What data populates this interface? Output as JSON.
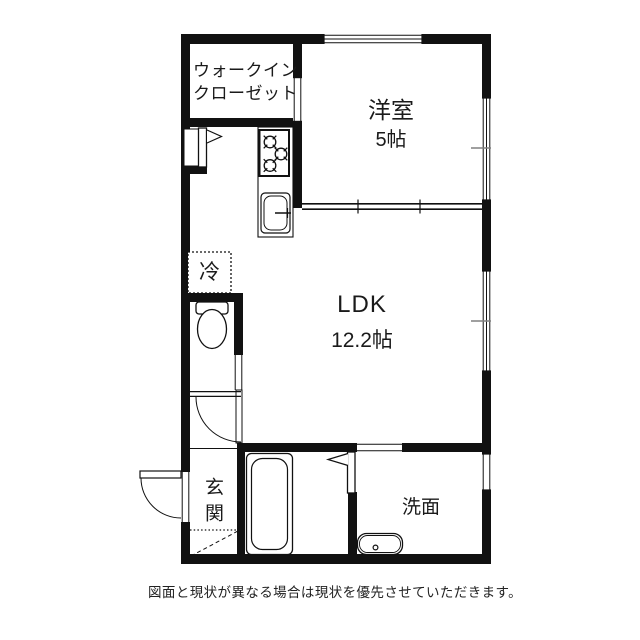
{
  "floorplan": {
    "rooms": {
      "walk_in_closet": {
        "label": "ウォークイン\nクローゼット"
      },
      "western_room": {
        "label": "洋室",
        "size": "5帖"
      },
      "ldk": {
        "label": "LDK",
        "size": "12.2帖"
      },
      "fridge_space": {
        "label": "冷"
      },
      "entrance": {
        "label": "玄関"
      },
      "washroom": {
        "label": "洗面"
      }
    },
    "disclaimer": "図面と現状が異なる場合は現状を優先させていただきます。",
    "colors": {
      "wall": "#111111",
      "text": "#1a1a1a",
      "window_tick": "#808080",
      "background": "#ffffff"
    }
  }
}
